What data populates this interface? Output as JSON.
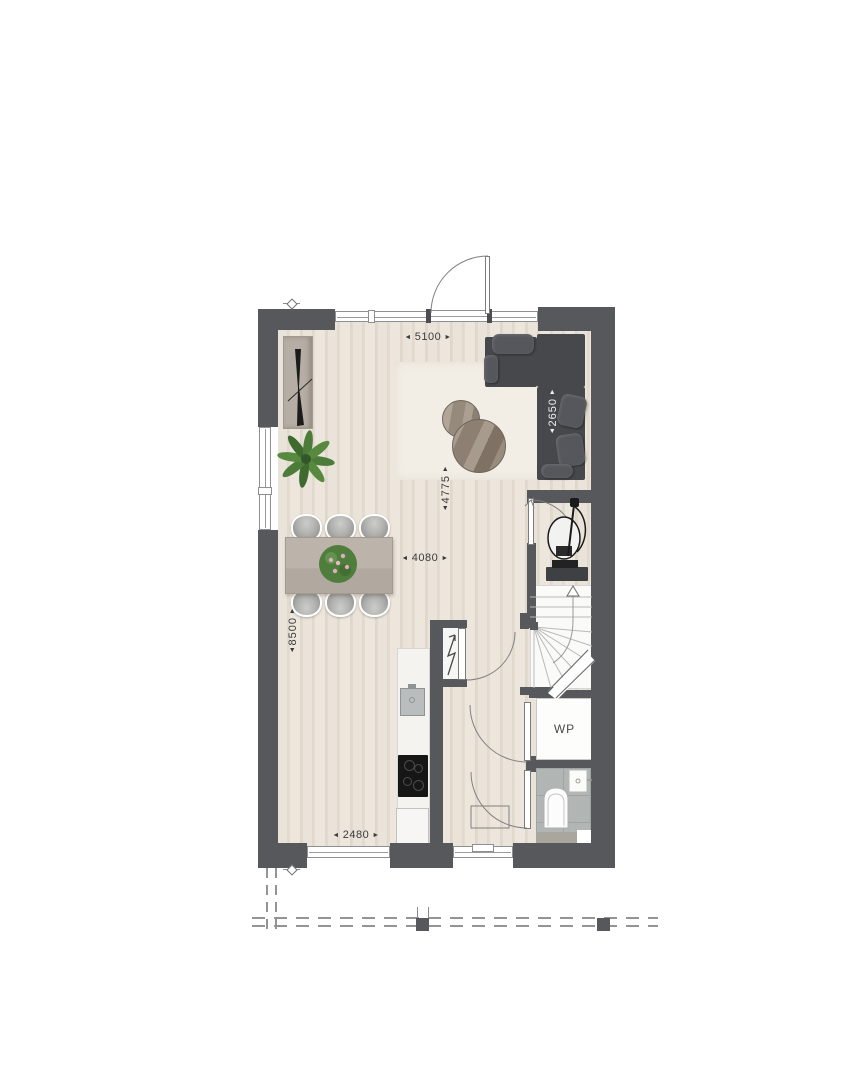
{
  "labels": {
    "heat_pump": "WP"
  },
  "dims": {
    "d5100": "5100",
    "d2650": "2650",
    "d4775": "4775",
    "d4080": "4080",
    "d8500": "8500",
    "d2480": "2480"
  },
  "glyphs": {
    "left": "◄",
    "right": "►",
    "up": "▲",
    "down": "▼"
  },
  "colors": {
    "wall": "#57585b",
    "floor_wood": "#e8e1d8",
    "floor_plank_line": "#ddd3c7",
    "rug": "#f2eee6",
    "sofa": "#47484c",
    "sofa_cushion": "#56575c",
    "dining_table": "#b6ada4",
    "chair": "#a3a3a1",
    "plant_green": "#4e7e3b",
    "flower_pink": "#dcaec0",
    "toilet_tile": "#b1b6b5",
    "counter": "#f4f3f0",
    "cooktop": "#161616",
    "stair": "#fafaf9",
    "door_line": "#7c7c7c",
    "dim_text": "#3b3b3b",
    "dim_text_on_sofa": "#f1f1f1",
    "boundary_dash": "#949494"
  }
}
